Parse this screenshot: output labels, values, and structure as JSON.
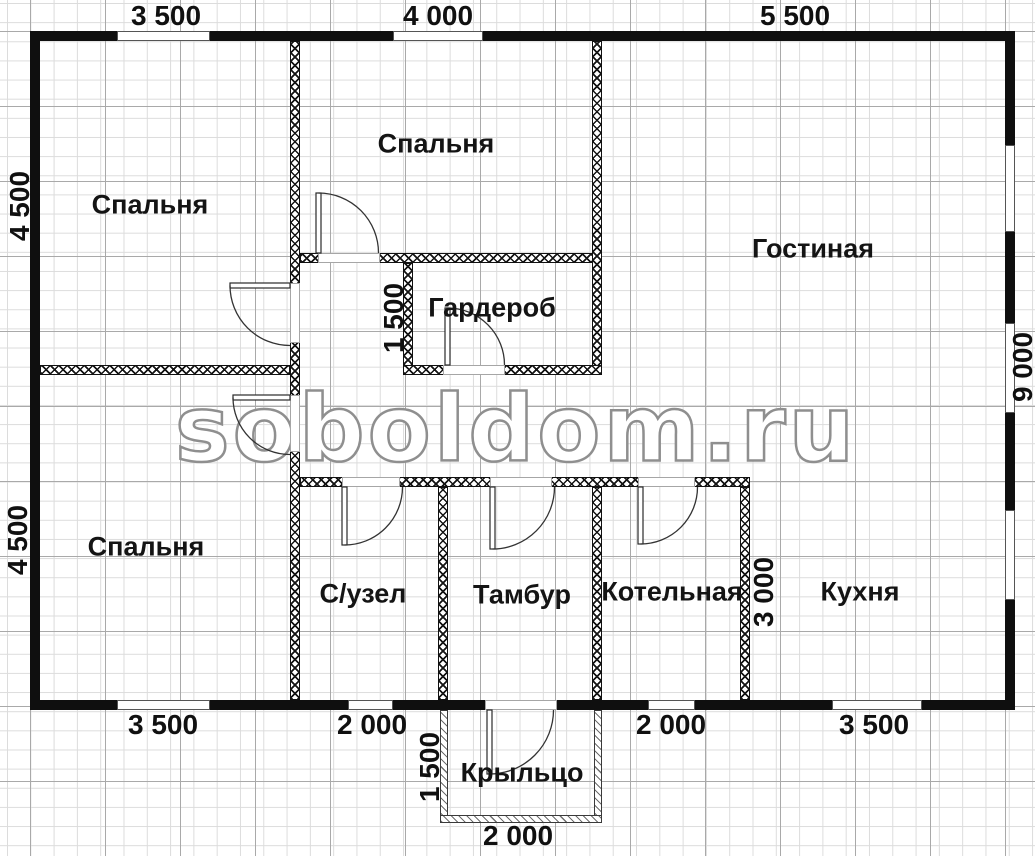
{
  "watermark": "soboldom.ru",
  "rooms": {
    "bedroom_top_left": "Спальня",
    "bedroom_top_middle": "Спальня",
    "living_room": "Гостиная",
    "wardrobe": "Гардероб",
    "bedroom_bottom_left": "Спальня",
    "bathroom": "С/узел",
    "vestibule": "Тамбур",
    "boiler_room": "Котельная",
    "kitchen": "Кухня",
    "porch": "Крыльцо"
  },
  "dimensions": {
    "top": [
      "3 500",
      "4 000",
      "5 500"
    ],
    "bottom": [
      "3 500",
      "2 000",
      "2 000",
      "3 500"
    ],
    "left": [
      "4 500",
      "4 500"
    ],
    "right": [
      "9 000"
    ],
    "interior": {
      "wardrobe_depth": "1 500",
      "boiler_width": "3 000",
      "porch_depth": "1 500",
      "porch_width": "2 000"
    }
  },
  "colors": {
    "wall": "#0f0f0f",
    "grid_minor": "#dcdcdc",
    "grid_major": "#a9a9a9",
    "text": "#101010",
    "watermark_outline": "#8f8f8f"
  }
}
